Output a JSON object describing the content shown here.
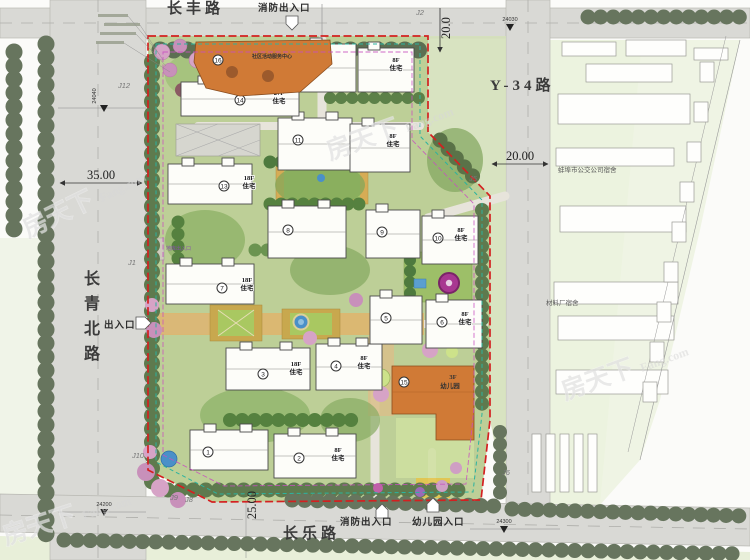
{
  "roads": {
    "north": "长丰路",
    "south": "长乐路",
    "east": "Y-34路",
    "west_chars": [
      "长",
      "青",
      "北",
      "路"
    ]
  },
  "entrances": {
    "north_fire": "消防出入口",
    "west_main": "出入口",
    "south_fire": "消防出入口",
    "kindergarten": "幼儿园入口"
  },
  "dimensions": {
    "west": "35.00",
    "north": "20.0",
    "east": "20.00",
    "south": "25.00"
  },
  "stations": {
    "nw": "24040",
    "ne": "24030",
    "sw": "24200",
    "se": "24300"
  },
  "junctions": {
    "j12": "J12",
    "j2": "J2",
    "j1": "J1",
    "j5": "J5",
    "j6": "J6",
    "j8": "J8",
    "j9": "J9",
    "j10": "J10"
  },
  "buildings": [
    {
      "num": "1"
    },
    {
      "num": "2",
      "floors": "8F",
      "use": "住宅"
    },
    {
      "num": "3",
      "floors": "18F",
      "use": "住宅"
    },
    {
      "num": "4",
      "floors": "8F",
      "use": "住宅"
    },
    {
      "num": "5"
    },
    {
      "num": "6",
      "floors": "8F",
      "use": "住宅"
    },
    {
      "num": "7",
      "floors": "18F",
      "use": "住宅"
    },
    {
      "num": "8"
    },
    {
      "num": "9"
    },
    {
      "num": "10",
      "floors": "8F",
      "use": "住宅"
    },
    {
      "num": "11"
    },
    {
      "floors": "8F",
      "use": "住宅"
    },
    {
      "num": "13",
      "floors": "18F",
      "use": "住宅"
    },
    {
      "num": "14",
      "floors": "27F",
      "use": "住宅"
    },
    {
      "num": "12"
    },
    {
      "floors": "8F",
      "use": "住宅"
    }
  ],
  "special": {
    "kindergarten": {
      "num": "15",
      "floors": "3F",
      "name": "幼儿园"
    },
    "community_center": {
      "num": "16",
      "name": "社区活动服务中心"
    }
  },
  "neighbors": {
    "bus_company_dorm": "蚌埠市公交公司宿舍",
    "material_factory_dorm": "材料厂宿舍"
  },
  "annotations": {
    "garage_entrance": "地库出入口"
  },
  "watermark": {
    "brand": "房天下",
    "site": "Fang.com"
  }
}
